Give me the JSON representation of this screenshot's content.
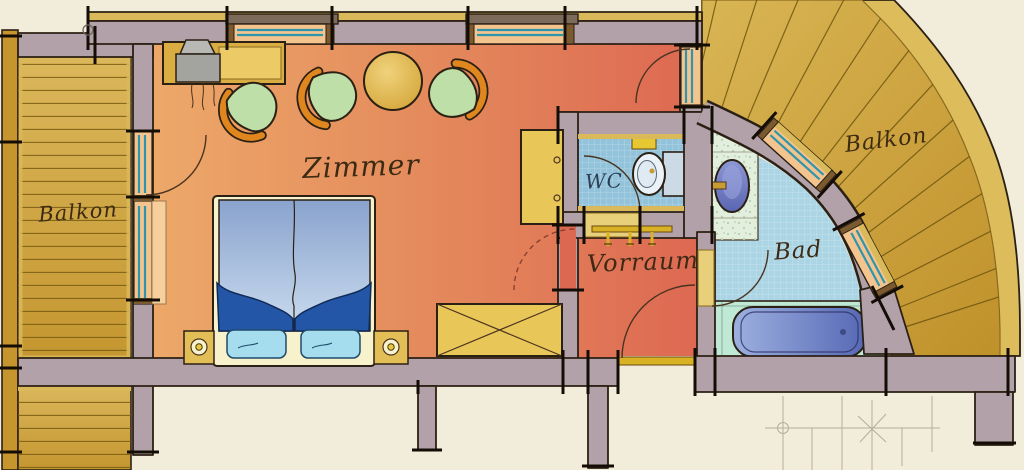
{
  "plan": {
    "labels": {
      "zimmer": "Zimmer",
      "vorraum": "Vorraum",
      "bad": "Bad",
      "wc": "WC",
      "balkon_left": "Balkon",
      "balkon_right": "Balkon"
    },
    "colors": {
      "background": "#f2ecda",
      "wall": "#b3a1aa",
      "wall_outline": "#2b2014",
      "room_warm": "#eda869",
      "room_red": "#dd6852",
      "balcony_wood": "#cda53c",
      "balcony_rim": "#ddbc5c",
      "insulation_gold": "#d9b959",
      "wc_tile": "#93c3da",
      "bad_tile": "#abd4e4",
      "platform_mint": "#bfe9d4",
      "counter_mint": "#e1efdc",
      "window_teal": "#2f95ac",
      "window_sill": "#f4c48f",
      "threshold_gold": "#d8b125",
      "furniture_gold": "#e9c658",
      "chair_green": "#bfdfa8",
      "chair_rim": "#e0861f",
      "table_gold": "#e5bf55",
      "duvet_blue": "#8aa3cd",
      "blanket_blue": "#2456a8",
      "pillow_cyan": "#a5dcee",
      "bed_base_cream": "#f7f2cc",
      "fixture_white": "#eaf2f7",
      "basin_blue": "#5a66b2",
      "tub_blue": "#5668b4",
      "pencil": "#b6ae9c"
    }
  }
}
